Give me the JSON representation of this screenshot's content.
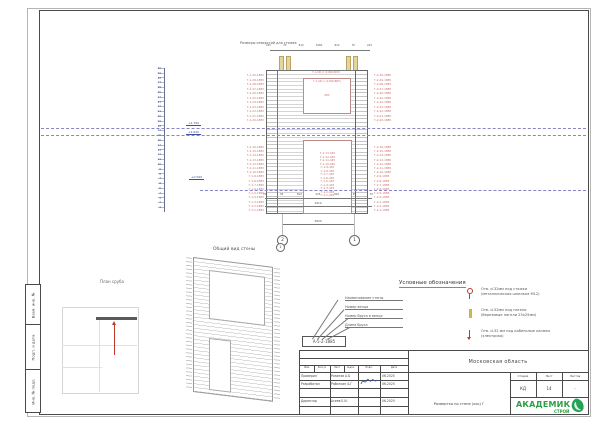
{
  "stamps": [
    "Взам. инв. №",
    "Подп. и дата",
    "Инв. № подл."
  ],
  "elevation_view": {
    "caption": "Размеры отверстий для стяжек",
    "top_dims": [
      "245",
      "70",
      "810",
      "1060",
      "810",
      "70",
      "245"
    ],
    "bottom_dims": [
      "70",
      "95",
      "810",
      "225",
      "810",
      "95",
      "70"
    ],
    "overall_dim": "2910",
    "axes_dim": "2820",
    "axis_left": "2",
    "axis_right": "1",
    "ruler_numbers": [
      "30",
      "29",
      "28",
      "27",
      "26",
      "25",
      "24",
      "23",
      "22",
      "21",
      "20",
      "19",
      "18",
      "17",
      "16",
      "15",
      "14",
      "13",
      "12",
      "11",
      "10",
      "9",
      "8",
      "7",
      "6",
      "5",
      "4",
      "3",
      "2",
      "1"
    ],
    "elev_mark_upper": "+2,790",
    "elev_mark_mid": "+2,640",
    "elev_mark_lower": "+0,590",
    "window_top_label": "Г-1-ОК-2 (1160х600)",
    "window_label": "Г-1-ОК-1 (1160х885)",
    "window_dim": "885",
    "left_labels_upper": [
      "Г-1-30-1885",
      "Г-1-29-1885",
      "Г-1-28-1885",
      "Г-1-27-1885",
      "Г-1-26-1885",
      "Г-1-25-1885",
      "Г-1-24-1885",
      "Г-1-23-1885",
      "Г-1-22-1885",
      "Г-1-21-1885",
      "Г-1-20-1885"
    ],
    "left_labels_lower": [
      "Г-1-16-1885",
      "Г-1-15-1885",
      "Г-1-14-1885",
      "Г-1-13-1885",
      "Г-1-12-1885",
      "Г-1-11-1885",
      "Г-1-10-1885",
      "Г-1-9-1885",
      "Г-1-8-1885",
      "Г-1-7-1885",
      "Г-1-6-1885",
      "Г-1-5-1885",
      "Г-1-4-1885",
      "Г-1-3-1885",
      "Г-1-2-1885",
      "Г-1-1-1885"
    ],
    "right_labels_upper": [
      "Г-2-30-1885",
      "Г-2-29-1885",
      "Г-2-28-1885",
      "Г-2-27-1885",
      "Г-2-26-1885",
      "Г-2-25-1885",
      "Г-2-24-1885",
      "Г-2-23-1885",
      "Г-2-22-1885",
      "Г-2-21-1885",
      "Г-2-20-1885"
    ],
    "right_labels_lower": [
      "Г-2-16-1885",
      "Г-2-15-1885",
      "Г-2-14-1885",
      "Г-2-13-1885",
      "Г-2-12-1885",
      "Г-2-11-1885",
      "Г-2-10-1885",
      "Г-2-9-1885",
      "Г-2-8-1885",
      "Г-2-7-1885",
      "Г-2-6-1885",
      "Г-2-5-1885",
      "Г-2-4-1885",
      "Г-2-3-1885",
      "Г-2-2-1885",
      "Г-2-1-1885"
    ],
    "opening_labels": [
      "Г-1-13-445",
      "Г-1-12-445",
      "Г-1-11-445",
      "Г-1-10-445",
      "Г-1-9-445",
      "Г-1-8-445",
      "Г-1-7-445",
      "Г-1-6-445",
      "Г-1-5-445",
      "Г-1-4-445",
      "Г-1-3-445",
      "Г-1-2-445",
      "Г-1-1-445"
    ]
  },
  "axono": {
    "title": "Общий вид стены",
    "axis": "1"
  },
  "plan": {
    "title": "План сруба"
  },
  "callout": {
    "mark": "А-5-2-1885",
    "labels": [
      "Наименование стены",
      "Номер венца",
      "Номер бруса в венце",
      "Длина бруса"
    ]
  },
  "legend": {
    "title": "Условные обозначения",
    "items": [
      {
        "line1": "Отв. d-32мм под стяжки",
        "line2": "(металлическая шпилька М12)"
      },
      {
        "line1": "Отв. d-32мм под нагели",
        "line2": "(березовые нагели 25х25мм)"
      },
      {
        "line1": "Отв. d-32 мм под кабельные каналы",
        "line2": "(электрика)"
      }
    ]
  },
  "titleblock": {
    "header_cols": [
      "Изм.",
      "Кол.уч",
      "Лист",
      "№док.",
      "Подп.",
      "Дата"
    ],
    "rows": [
      {
        "role": "Проверил",
        "name": "Розанов А.Б",
        "date": "06.2025"
      },
      {
        "role": "Разработал",
        "name": "Работкин А.Г",
        "date": "06.2025"
      },
      {
        "role": "Директор",
        "name": "Асеев Е.И.",
        "date": "06.2025"
      }
    ],
    "region": "Московская область",
    "doc_title": "Развертка по стене (ось) Г",
    "stage_headers": [
      "Стадия",
      "Лист",
      "Листов"
    ],
    "stage_values": [
      "КД",
      "14",
      "-"
    ],
    "logo": {
      "line1": "АКАДЕМИК",
      "line2": "СТРОЙ"
    }
  }
}
